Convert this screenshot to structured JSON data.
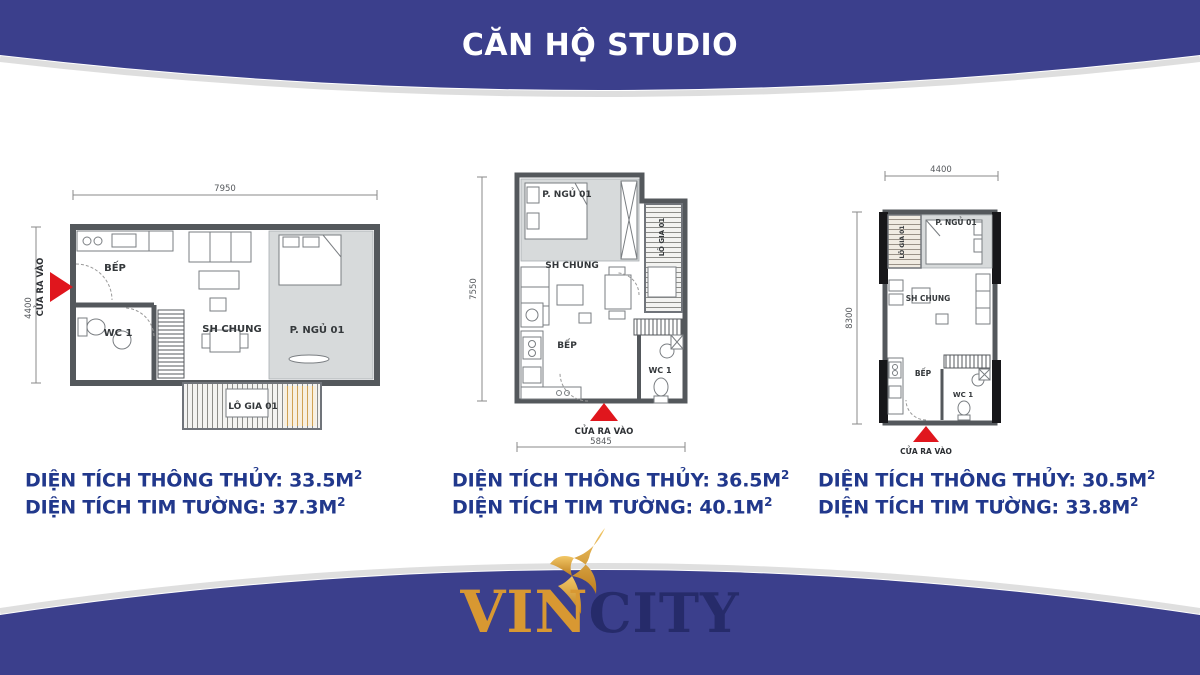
{
  "title": "CĂN HỘ STUDIO",
  "colors": {
    "banner_navy": "#3b3f8c",
    "area_text_blue": "#21388c",
    "entrance_red": "#e0161d",
    "logo_gold": "#d89832",
    "logo_city_navy": "#262b6a",
    "bedroom_fill": "#d7dadb",
    "wall_gray": "#54585c"
  },
  "plans": [
    {
      "dims": {
        "top": "7950",
        "left": "4400"
      },
      "entrance": "CỬA RA VÀO",
      "rooms": {
        "kitchen": "BẾP",
        "wc": "WC 1",
        "living": "SH CHUNG",
        "bedroom": "P. NGỦ 01",
        "balcony": "LÔ GIA 01"
      },
      "areas": [
        {
          "text": "DIỆN TÍCH THÔNG THỦY: 33.5M",
          "sup": "2"
        },
        {
          "text": "DIỆN TÍCH TIM TƯỜNG: 37.3M",
          "sup": "2"
        }
      ]
    },
    {
      "dims": {
        "left": "7550",
        "bottom": "5845"
      },
      "entrance": "CỬA RA VÀO",
      "rooms": {
        "kitchen": "BẾP",
        "wc": "WC 1",
        "living": "SH CHUNG",
        "bedroom": "P. NGỦ 01",
        "balcony": "LÔ GIA 01"
      },
      "areas": [
        {
          "text": "DIỆN TÍCH THÔNG THỦY: 36.5M",
          "sup": "2"
        },
        {
          "text": "DIỆN TÍCH TIM TƯỜNG: 40.1M",
          "sup": "2"
        }
      ]
    },
    {
      "dims": {
        "top": "4400",
        "left": "8300"
      },
      "entrance": "CỬA RA VÀO",
      "rooms": {
        "kitchen": "BẾP",
        "wc": "WC 1",
        "living": "SH CHUNG",
        "bedroom": "P. NGỦ 01",
        "balcony": "LÔ GIA 01"
      },
      "areas": [
        {
          "text": "DIỆN TÍCH THÔNG THỦY: 30.5M",
          "sup": "2"
        },
        {
          "text": "DIỆN TÍCH TIM TƯỜNG: 33.8M",
          "sup": "2"
        }
      ]
    }
  ],
  "logo": {
    "vin": "VIN",
    "city": "CITY"
  }
}
